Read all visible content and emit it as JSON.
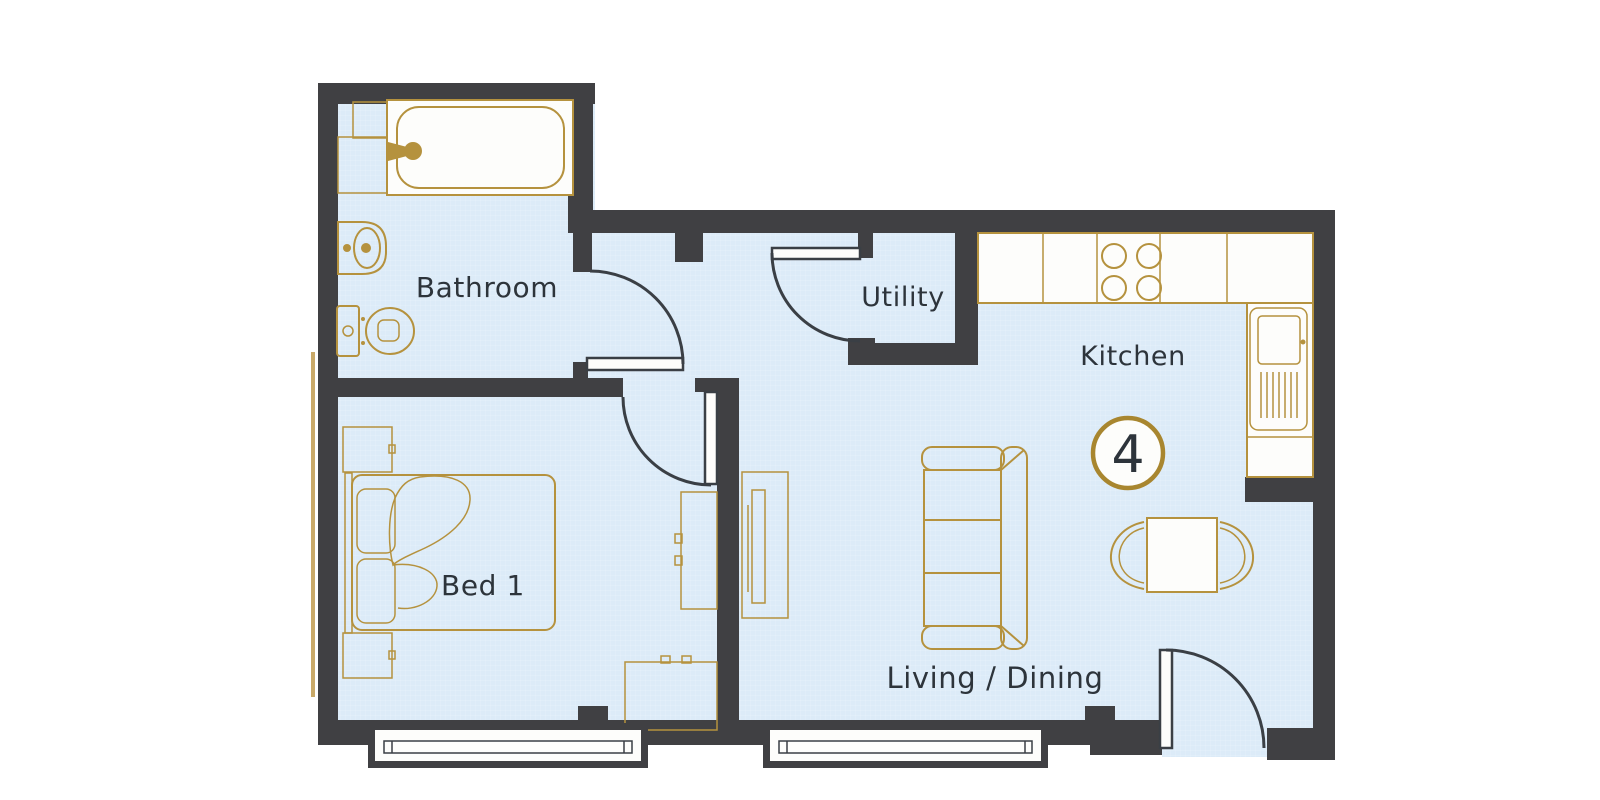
{
  "labels": {
    "bathroom": "Bathroom",
    "utility": "Utility",
    "kitchen": "Kitchen",
    "bed1": "Bed 1",
    "living_dining": "Living / Dining",
    "unit_number": "4"
  },
  "colors": {
    "wall": "#404043",
    "floor": "#dcebf8",
    "floor_line": "#e9f2fb",
    "fixture": "#b5923e",
    "fixture_soft": "#c9a968",
    "white": "#fdfdfb",
    "door": "#3a3f45",
    "label": "#2d343b",
    "badge_ring": "#a8862f"
  }
}
